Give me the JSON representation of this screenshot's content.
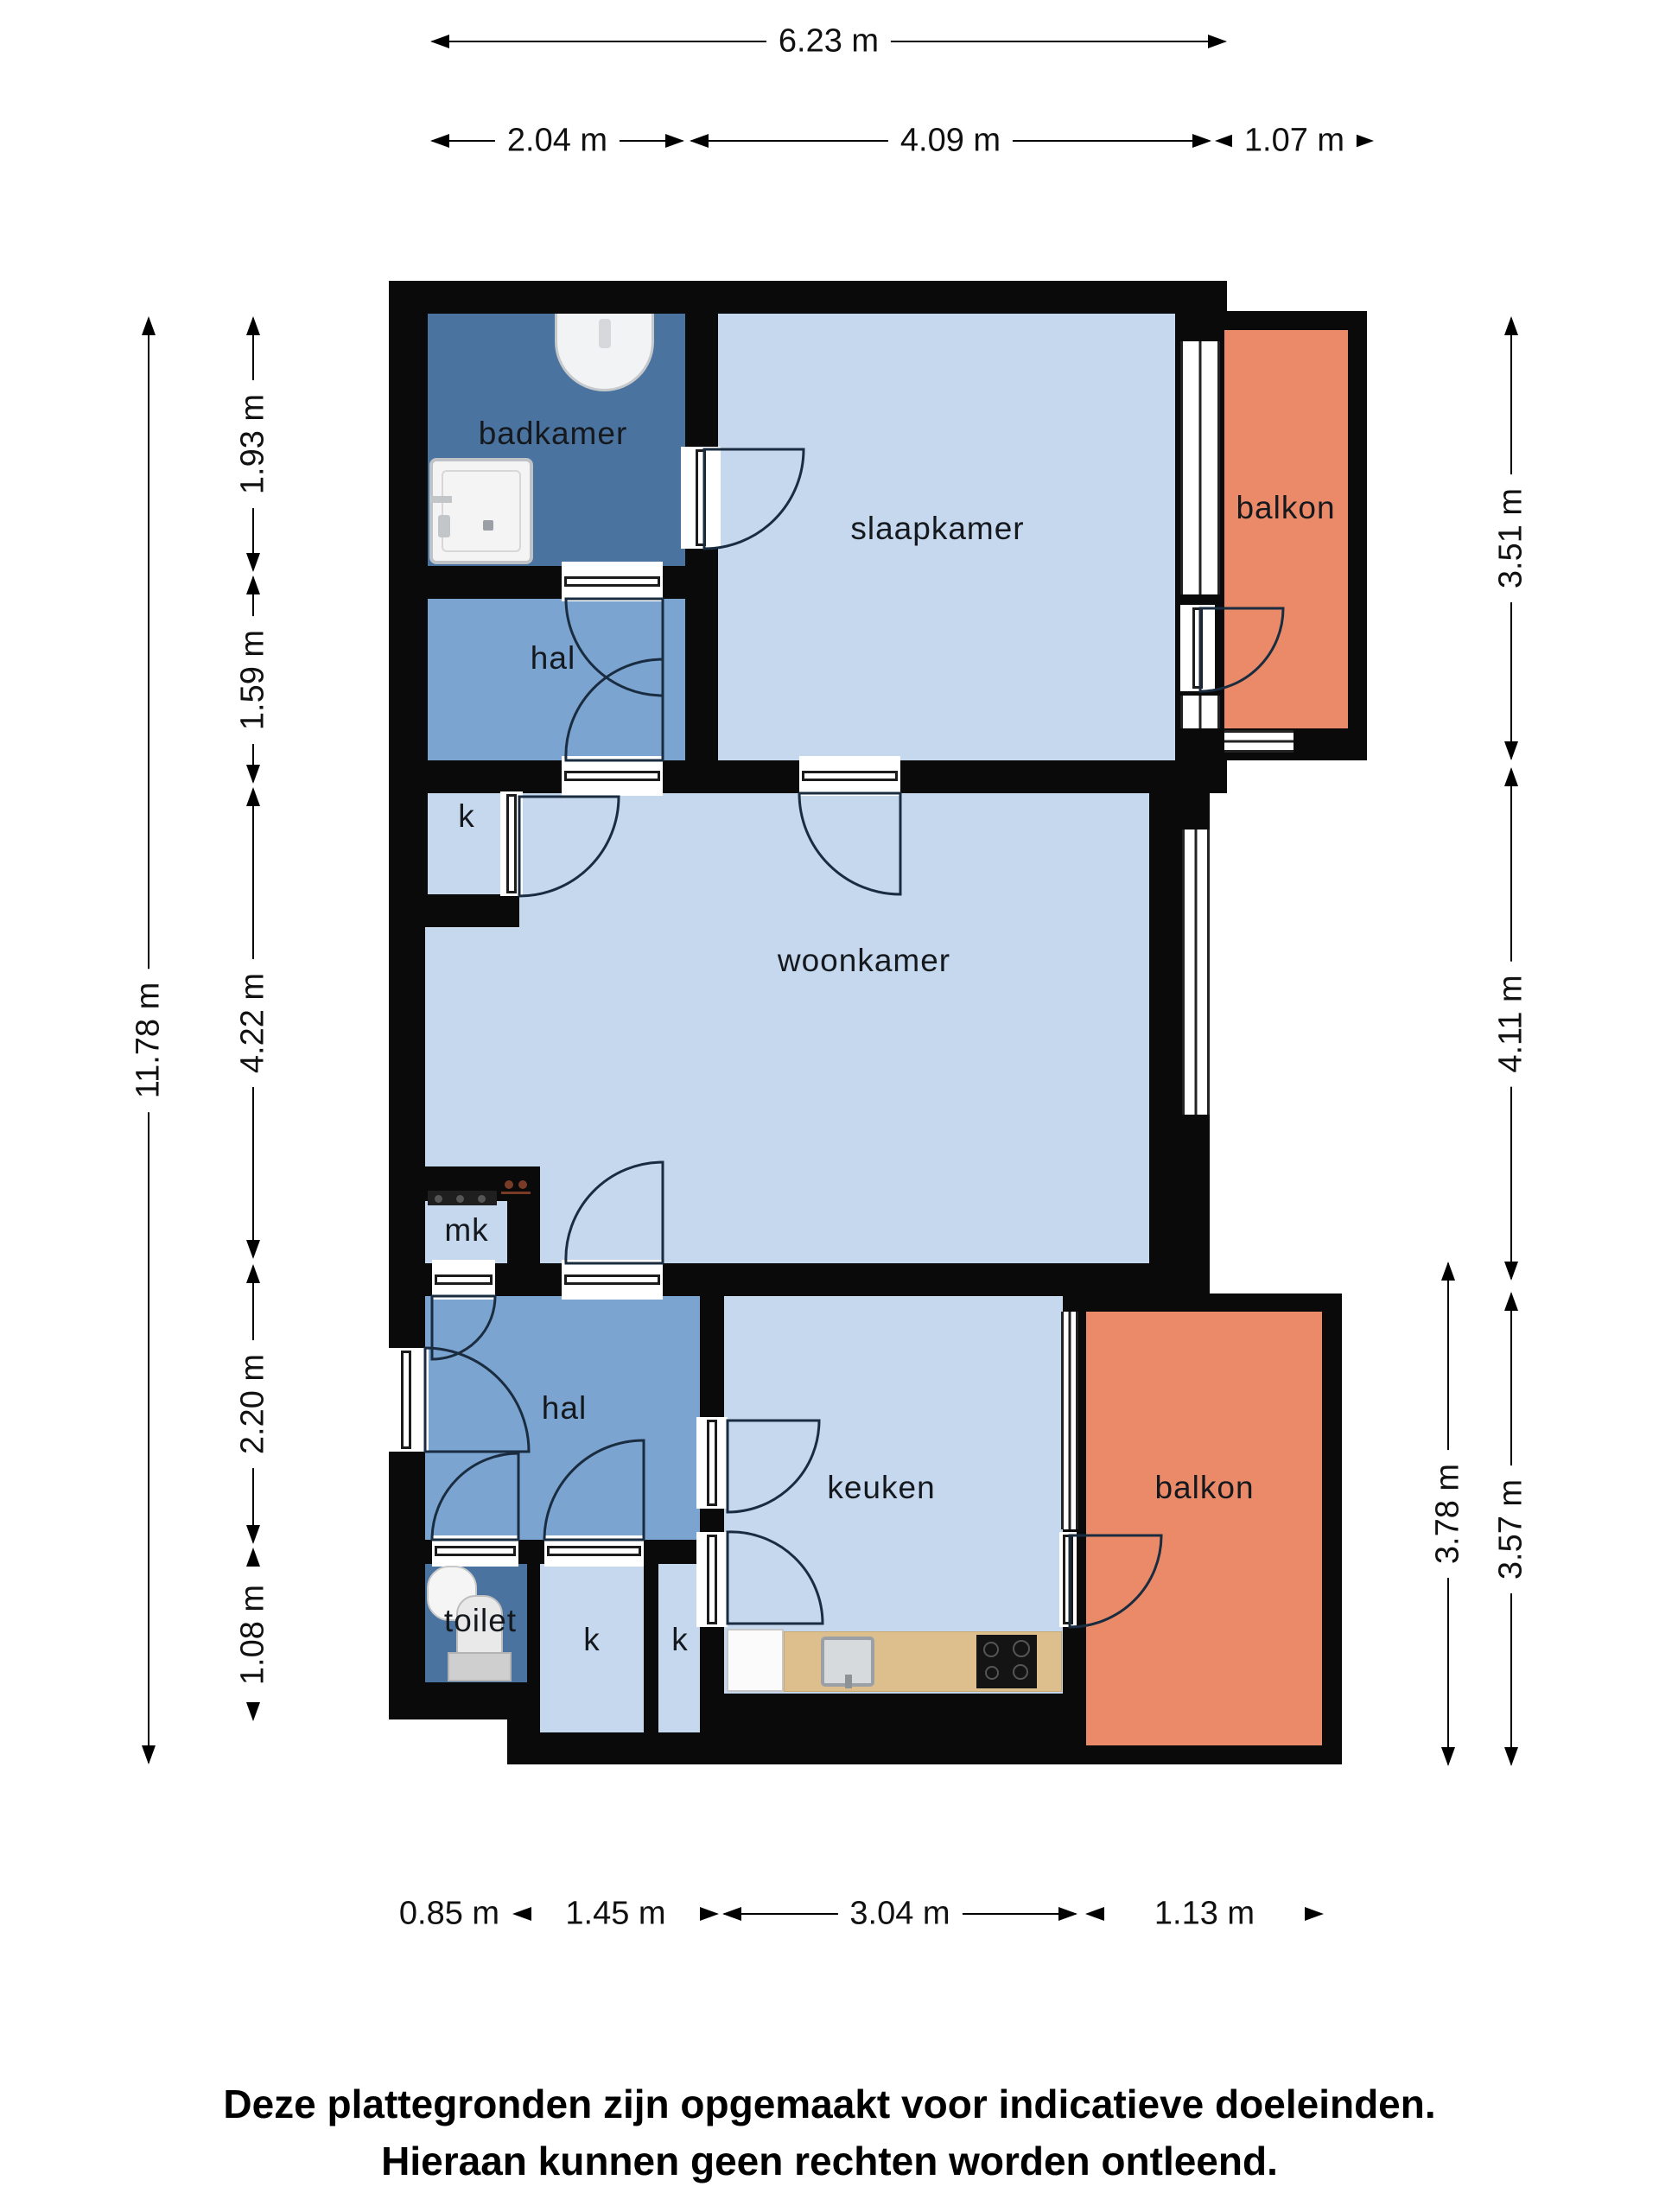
{
  "rooms": {
    "badkamer": "badkamer",
    "slaapkamer": "slaapkamer",
    "balkon_top": "balkon",
    "hal_top": "hal",
    "k_top": "k",
    "woonkamer": "woonkamer",
    "mk": "mk",
    "hal_low": "hal",
    "keuken": "keuken",
    "balkon_low": "balkon",
    "toilet": "toilet",
    "k_low_1": "k",
    "k_low_2": "k"
  },
  "dimensions": {
    "top_total": "6.23 m",
    "top_segments": [
      "2.04 m",
      "4.09 m",
      "1.07 m"
    ],
    "left_total": "11.78 m",
    "left_segments": [
      "1.93 m",
      "1.59 m",
      "4.22 m",
      "2.20 m",
      "1.08 m"
    ],
    "right_segments": [
      "3.51 m",
      "4.11 m",
      "3.78 m",
      "3.57 m"
    ],
    "bottom_segments": [
      "0.85 m",
      "1.45 m",
      "3.04 m",
      "1.13 m"
    ]
  },
  "disclaimer": {
    "line1": "Deze plattegronden zijn opgemaakt voor indicatieve doeleinden.",
    "line2": "Hieraan kunnen geen rechten worden ontleend."
  },
  "colors": {
    "wall": "#0a0a0a",
    "room_light": "#c5d8ee",
    "room_medium": "#7ba4d0",
    "room_dark": "#4a739f",
    "balcony": "#ea8a68",
    "counter_wood": "#ddbf8e"
  }
}
